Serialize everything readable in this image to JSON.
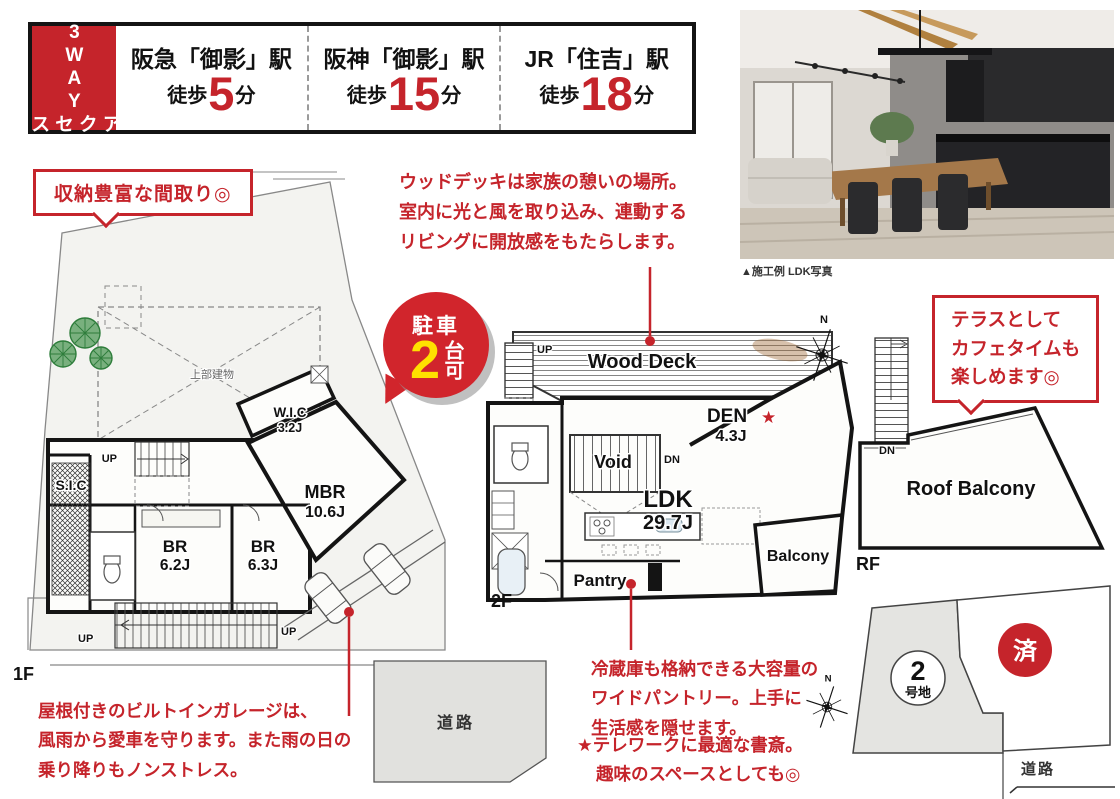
{
  "colors": {
    "accent_red": "#c5242b",
    "badge_red": "#d1252c",
    "badge_number_yellow": "#ffe100",
    "wall_black": "#141414",
    "road_gray": "#e1e1de",
    "lot_gray": "#f3f3f0"
  },
  "access": {
    "tag_line1": "3WAY",
    "tag_line2": "アクセス",
    "stations": [
      {
        "name": "阪急「御影」駅",
        "walk": "徒歩",
        "minutes": "5",
        "unit": "分"
      },
      {
        "name": "阪神「御影」駅",
        "walk": "徒歩",
        "minutes": "15",
        "unit": "分"
      },
      {
        "name": "JR「住吉」駅",
        "walk": "徒歩",
        "minutes": "18",
        "unit": "分"
      }
    ]
  },
  "photo": {
    "caption": "▲施工例 LDK写真"
  },
  "parking_badge": {
    "top": "駐車",
    "number": "2",
    "side": "台可"
  },
  "callout_storage": {
    "text": "収納豊富な間取り◎"
  },
  "callout_terrace": {
    "lines": [
      "テラスとして",
      "カフェタイムも",
      "楽しめます◎"
    ]
  },
  "note_wood_deck": {
    "lines": [
      "ウッドデッキは家族の憩いの場所。",
      "室内に光と風を取り込み、連動する",
      "リビングに開放感をもたらします。"
    ]
  },
  "note_garage": {
    "lines": [
      "屋根付きのビルトインガレージは、",
      "風雨から愛車を守ります。また雨の日の",
      "乗り降りもノンストレス。"
    ]
  },
  "note_pantry": {
    "lines": [
      "冷蔵庫も格納できる大容量の",
      "ワイドパントリー。上手に",
      "生活感を隠せます。"
    ]
  },
  "note_den": {
    "lines": [
      "★テレワークに最適な書斎。",
      "趣味のスペースとしても◎"
    ]
  },
  "plan_1f": {
    "floor_label": "1F",
    "upper_building": "上部建物",
    "sic": "S.I.C",
    "wic": "W.I.C",
    "wic_size": "3.2J",
    "mbr": "MBR",
    "mbr_size": "10.6J",
    "br1": "BR",
    "br1_size": "6.2J",
    "br2": "BR",
    "br2_size": "6.3J",
    "up": "UP"
  },
  "plan_2f": {
    "floor_label": "2F",
    "wood_deck": "Wood Deck",
    "den": "DEN",
    "den_star": "★",
    "den_size": "4.3J",
    "void": "Void",
    "ldk": "LDK",
    "ldk_size": "29.7J",
    "balcony": "Balcony",
    "pantry": "Pantry",
    "up": "UP",
    "dn": "DN",
    "north": "N"
  },
  "plan_rf": {
    "floor_label": "RF",
    "roof_balcony": "Roof Balcony",
    "dn": "DN"
  },
  "site": {
    "lot_number": "2",
    "lot_suffix": "号地",
    "sold": "済",
    "road": "道路",
    "north": "N"
  },
  "road_center": {
    "label": "道路"
  }
}
